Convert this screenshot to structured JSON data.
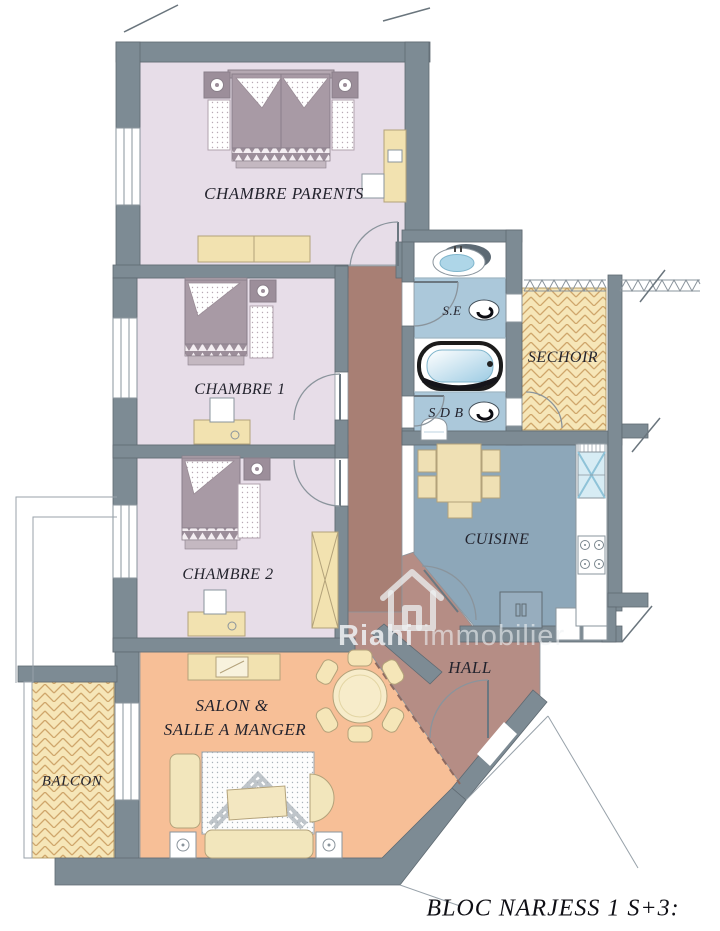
{
  "title": "BLOC NARJESS 1 S+3:",
  "watermark": {
    "brand": "Riahi",
    "rest": "immobilier"
  },
  "rooms": {
    "chambre_parents": "CHAMBRE PARENTS",
    "chambre_1": "CHAMBRE 1",
    "chambre_2": "CHAMBRE 2",
    "salon_line1": "SALON &",
    "salon_line2": "SALLE A MANGER",
    "balcon": "BALCON",
    "sechoir": "SECHOIR",
    "cuisine": "CUISINE",
    "hall": "HALL",
    "se": "S.E",
    "sdb": "S D B"
  },
  "colors": {
    "wall": "#7d8b94",
    "bedroom_floor": "#e7dde8",
    "bath_floor": "#abc8da",
    "kitchen_floor": "#8da7b9",
    "corridor_floor": "#a87f74",
    "hall_floor": "#b58d85",
    "salon_floor": "#f7bf97",
    "tile_floor": "#f6e6b8",
    "furniture_wood": "#f2e2b0",
    "bed_fabric": "#a89aa5",
    "label_ink": "#23232d"
  }
}
